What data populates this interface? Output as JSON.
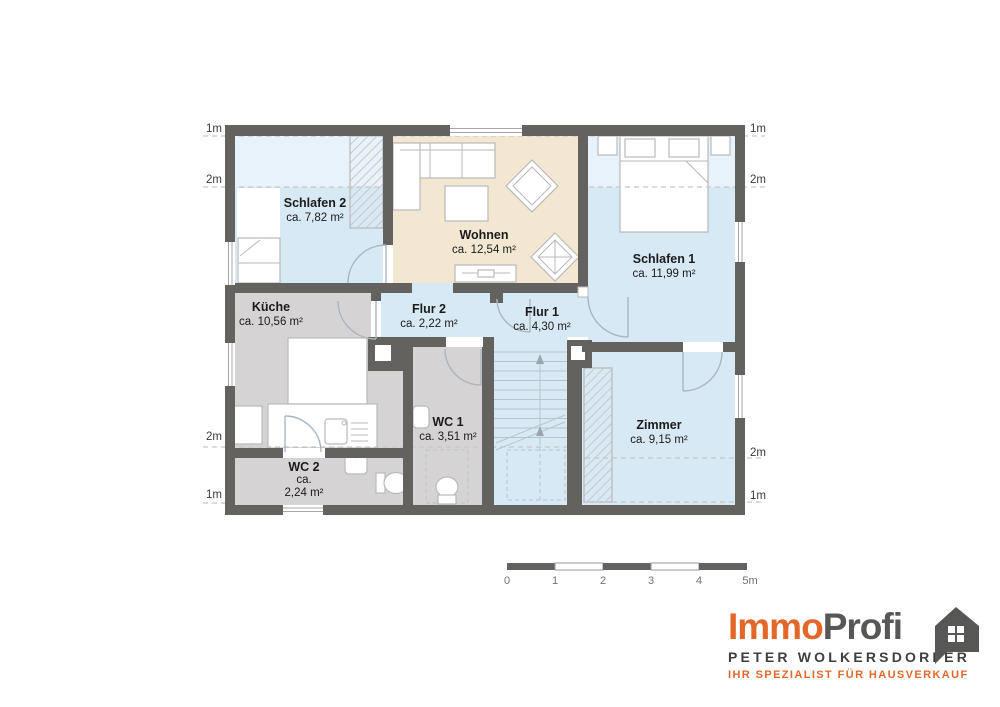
{
  "plan": {
    "rooms": [
      {
        "id": "schlafen2",
        "name": "Schlafen 2",
        "area": "ca. 7,82 m²"
      },
      {
        "id": "wohnen",
        "name": "Wohnen",
        "area": "ca. 12,54 m²"
      },
      {
        "id": "schlafen1",
        "name": "Schlafen 1",
        "area": "ca. 11,99 m²"
      },
      {
        "id": "kueche",
        "name": "Küche",
        "area": "ca. 10,56 m²"
      },
      {
        "id": "flur2",
        "name": "Flur 2",
        "area": "ca. 2,22 m²"
      },
      {
        "id": "flur1",
        "name": "Flur 1",
        "area": "ca. 4,30 m²"
      },
      {
        "id": "wc1",
        "name": "WC 1",
        "area": "ca. 3,51 m²"
      },
      {
        "id": "wc2",
        "name": "WC 2",
        "area_lines": [
          "ca.",
          "2,24 m²"
        ]
      },
      {
        "id": "zimmer",
        "name": "Zimmer",
        "area": "ca. 9,15 m²"
      }
    ],
    "height_markers": {
      "left": [
        "1m",
        "2m",
        "2m",
        "1m"
      ],
      "right": [
        "1m",
        "2m",
        "2m",
        "1m"
      ]
    }
  },
  "scalebar": {
    "labels": [
      "0",
      "1",
      "2",
      "3",
      "4",
      "5m"
    ]
  },
  "logo": {
    "brand_orange": "Immo",
    "brand_dark": "Profi",
    "person": "PETER WOLKERSDORFER",
    "tagline": "IHR SPEZIALIST FÜR HAUSVERKAUF"
  },
  "colors": {
    "wall": "#63625f",
    "room_blue": "#d7e9f5",
    "room_blue_light": "#e7f2fa",
    "room_beige": "#f2e8d2",
    "room_gray": "#d6d3d5",
    "accent_orange": "#e4672a",
    "logo_dark": "#575755",
    "door_arc": "#a9b6bf",
    "furniture_stroke": "#b9b9b9"
  }
}
